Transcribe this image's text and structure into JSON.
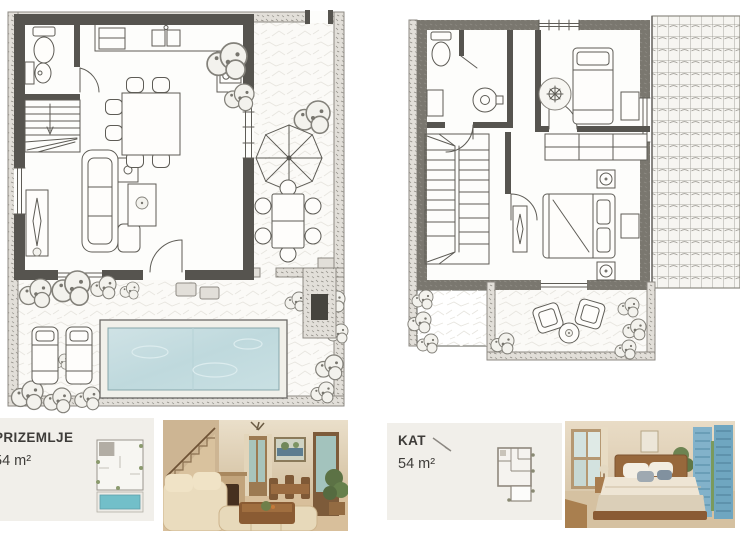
{
  "page": {
    "title": "Villa floor plan sheet",
    "background": "#ffffff"
  },
  "cards": [
    {
      "title": "PRIZEMLJE",
      "area": "54 m²"
    },
    {
      "title": "KAT",
      "area": "54 m²"
    }
  ],
  "plans": {
    "ground": {
      "label": "PRIZEMLJE (ground floor) plan",
      "features": [
        "bathroom with toilet and bidet",
        "staircase",
        "kitchen with sink and hob",
        "dining table with chairs",
        "sofa and coffee table",
        "tv console",
        "terrace with parasol",
        "outdoor dining table with chairs",
        "stone garden walls",
        "swimming pool",
        "two sun loungers",
        "garden shrubs",
        "barbecue",
        "stepping stones"
      ]
    },
    "upper": {
      "label": "KAT (upper floor) plan",
      "features": [
        "bathroom with toilet and wash basin",
        "staircase",
        "single bedroom with bed and round rug",
        "double bedroom with bed, nightstands and wardrobe",
        "console table",
        "balcony with two chairs and round table",
        "tiled roof"
      ]
    }
  },
  "photos": [
    {
      "label": "living room interior photo"
    },
    {
      "label": "bedroom interior photo"
    }
  ],
  "colors": {
    "pool_water": "#c3dde1",
    "thumbnail_pool": "#72bfc9",
    "card_background": "#f1efea",
    "text": "#3e3c39",
    "ink": "#5e5c56",
    "wall": "#56544f",
    "shutter_blue": "#7fb0c8"
  }
}
